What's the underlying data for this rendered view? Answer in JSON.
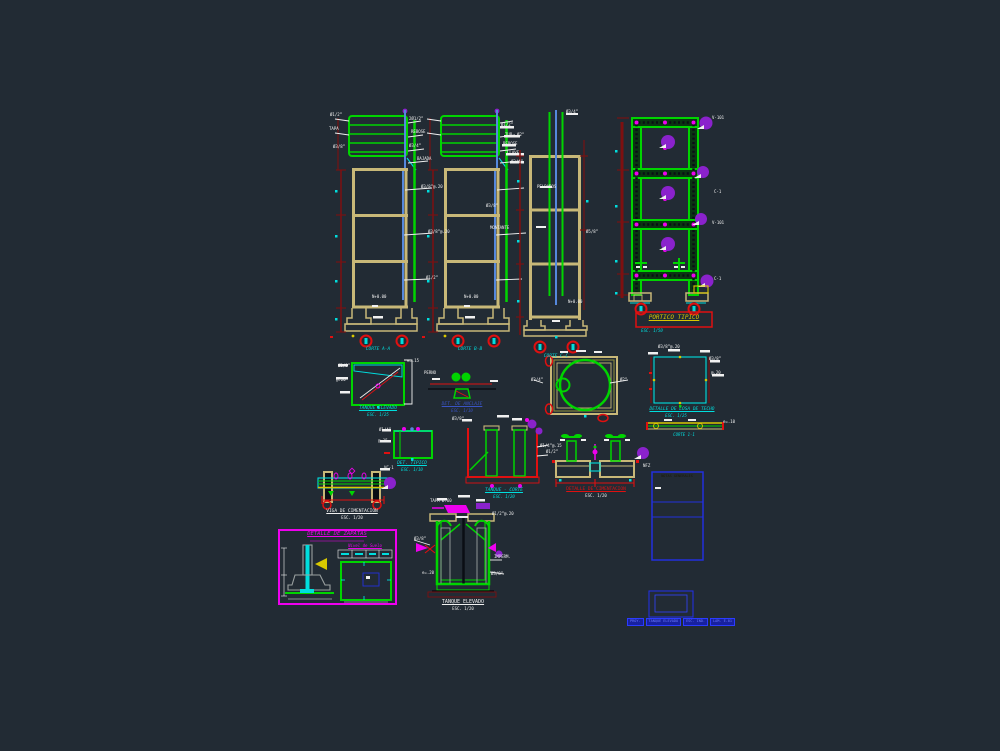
{
  "colors": {
    "bg": "#222b34",
    "green": "#00d400",
    "cyan": "#00dede",
    "tan": "#c8b878",
    "olive": "#8a8a3c",
    "lightblue": "#5588dd",
    "red": "#e01010",
    "darkred": "#7e1010",
    "magenta": "#ee00ee",
    "purple": "#8a22cc",
    "yellow": "#d8c800",
    "white": "#f0f0f0",
    "gray": "#9aa0a0",
    "blue": "#2230dd"
  },
  "labels": {
    "tower1": "CORTE A-A",
    "tower2": "CORTE B-B",
    "tower3": "CORTE C-C",
    "portico_title": "PORTICO TIPICO",
    "portico_scale": "ESC. 1/50",
    "tankwall_1": "TANQUE ELEVADO",
    "tankwall_2": "ESC. 1/25",
    "anchor_1": "DET. DE ANCLAJE",
    "anchor_2": "ESC. 1/10",
    "slab_1": "DETALLE DE LOSA DE TECHO",
    "slab_2": "ESC. 1/25",
    "slab_3": "CORTE 1-1",
    "small_1": "DET. TIPICO",
    "small_2": "ESC. 1/10",
    "wallsec_1": "TANQUE - CORTE",
    "wallsec_2": "ESC. 1/20",
    "found_1": "DETALLE DE CIMENTACION",
    "found_2": "ESC. 1/20",
    "beam_1": "VIGA DE CIMENTACION",
    "beam_2": "ESC. 1/20",
    "zap_title": "DETALLE DE ZAPATAS",
    "zap_table": "Nivel de Suelo",
    "center_1": "TANQUE ELEVADO",
    "center_2": "ESC. 1/20",
    "notes_header": "NOTAS GENERALES"
  },
  "banner": {
    "segments": [
      "PROY.",
      "TANQUE ELEVADO",
      "ESC. IND.",
      "LAM. E-01"
    ]
  },
  "callouts": [
    {
      "x": 330,
      "y": 113,
      "t": "Ø1/2”"
    },
    {
      "x": 329,
      "y": 127,
      "t": "TAPA"
    },
    {
      "x": 333,
      "y": 145,
      "t": "Ø3/8”"
    },
    {
      "x": 409,
      "y": 117,
      "t": "2Ø1/2”"
    },
    {
      "x": 411,
      "y": 130,
      "t": "REBOSE"
    },
    {
      "x": 409,
      "y": 144,
      "t": "Ø3/4”"
    },
    {
      "x": 417,
      "y": 157,
      "t": "BAJADA"
    },
    {
      "x": 421,
      "y": 185,
      "t": "Ø3/8”@.20"
    },
    {
      "x": 428,
      "y": 230,
      "t": "Ø3/8”@.20"
    },
    {
      "x": 426,
      "y": 276,
      "t": "Ø1/2”"
    },
    {
      "x": 372,
      "y": 295,
      "t": "N+0.00"
    },
    {
      "x": 501,
      "y": 123,
      "t": "Ø1/2”"
    },
    {
      "x": 505,
      "y": 133,
      "t": "TUB. Ø2”"
    },
    {
      "x": 503,
      "y": 142,
      "t": "REBOSE"
    },
    {
      "x": 507,
      "y": 151,
      "t": "LLAVE"
    },
    {
      "x": 511,
      "y": 160,
      "t": "Ø3/4”"
    },
    {
      "x": 486,
      "y": 204,
      "t": "Ø3/8”"
    },
    {
      "x": 490,
      "y": 226,
      "t": "MONTANTE"
    },
    {
      "x": 464,
      "y": 295,
      "t": "N+0.00"
    },
    {
      "x": 566,
      "y": 110,
      "t": "Ø3/4”"
    },
    {
      "x": 537,
      "y": 185,
      "t": "PELDAÑOS"
    },
    {
      "x": 586,
      "y": 230,
      "t": "Ø5/8”"
    },
    {
      "x": 568,
      "y": 300,
      "t": "N+0.00"
    },
    {
      "x": 712,
      "y": 116,
      "t": "V-101"
    },
    {
      "x": 714,
      "y": 190,
      "t": "C-1"
    },
    {
      "x": 712,
      "y": 221,
      "t": "V-101"
    },
    {
      "x": 714,
      "y": 277,
      "t": "C-1"
    },
    {
      "x": 338,
      "y": 364,
      "t": "Ø3/8”"
    },
    {
      "x": 336,
      "y": 378,
      "t": "@.20"
    },
    {
      "x": 407,
      "y": 359,
      "t": "e=.15"
    },
    {
      "x": 424,
      "y": 371,
      "t": "PERNO"
    },
    {
      "x": 620,
      "y": 378,
      "t": "Ø2”"
    },
    {
      "x": 531,
      "y": 378,
      "t": "Ø3/4”"
    },
    {
      "x": 658,
      "y": 345,
      "t": "Ø3/8”@.20"
    },
    {
      "x": 709,
      "y": 357,
      "t": "Ø3/8”"
    },
    {
      "x": 711,
      "y": 371,
      "t": "@.20"
    },
    {
      "x": 723,
      "y": 420,
      "t": "e=.10"
    },
    {
      "x": 379,
      "y": 428,
      "t": "Ø1/4”"
    },
    {
      "x": 378,
      "y": 439,
      "t": "@.15"
    },
    {
      "x": 452,
      "y": 417,
      "t": "Ø3/8”"
    },
    {
      "x": 540,
      "y": 444,
      "t": "Ø1/4”@.15"
    },
    {
      "x": 546,
      "y": 450,
      "t": "Ø1/2”"
    },
    {
      "x": 643,
      "y": 464,
      "t": "NFZ"
    },
    {
      "x": 384,
      "y": 466,
      "t": "VC-1"
    },
    {
      "x": 430,
      "y": 499,
      "t": "TAPA Ø.60"
    },
    {
      "x": 414,
      "y": 537,
      "t": "Ø3/8”"
    },
    {
      "x": 492,
      "y": 512,
      "t": "Ø1/2”@.20"
    },
    {
      "x": 494,
      "y": 555,
      "t": "IMPERM."
    },
    {
      "x": 491,
      "y": 572,
      "t": "Ø3/8”"
    },
    {
      "x": 422,
      "y": 571,
      "t": "e=.20"
    }
  ]
}
